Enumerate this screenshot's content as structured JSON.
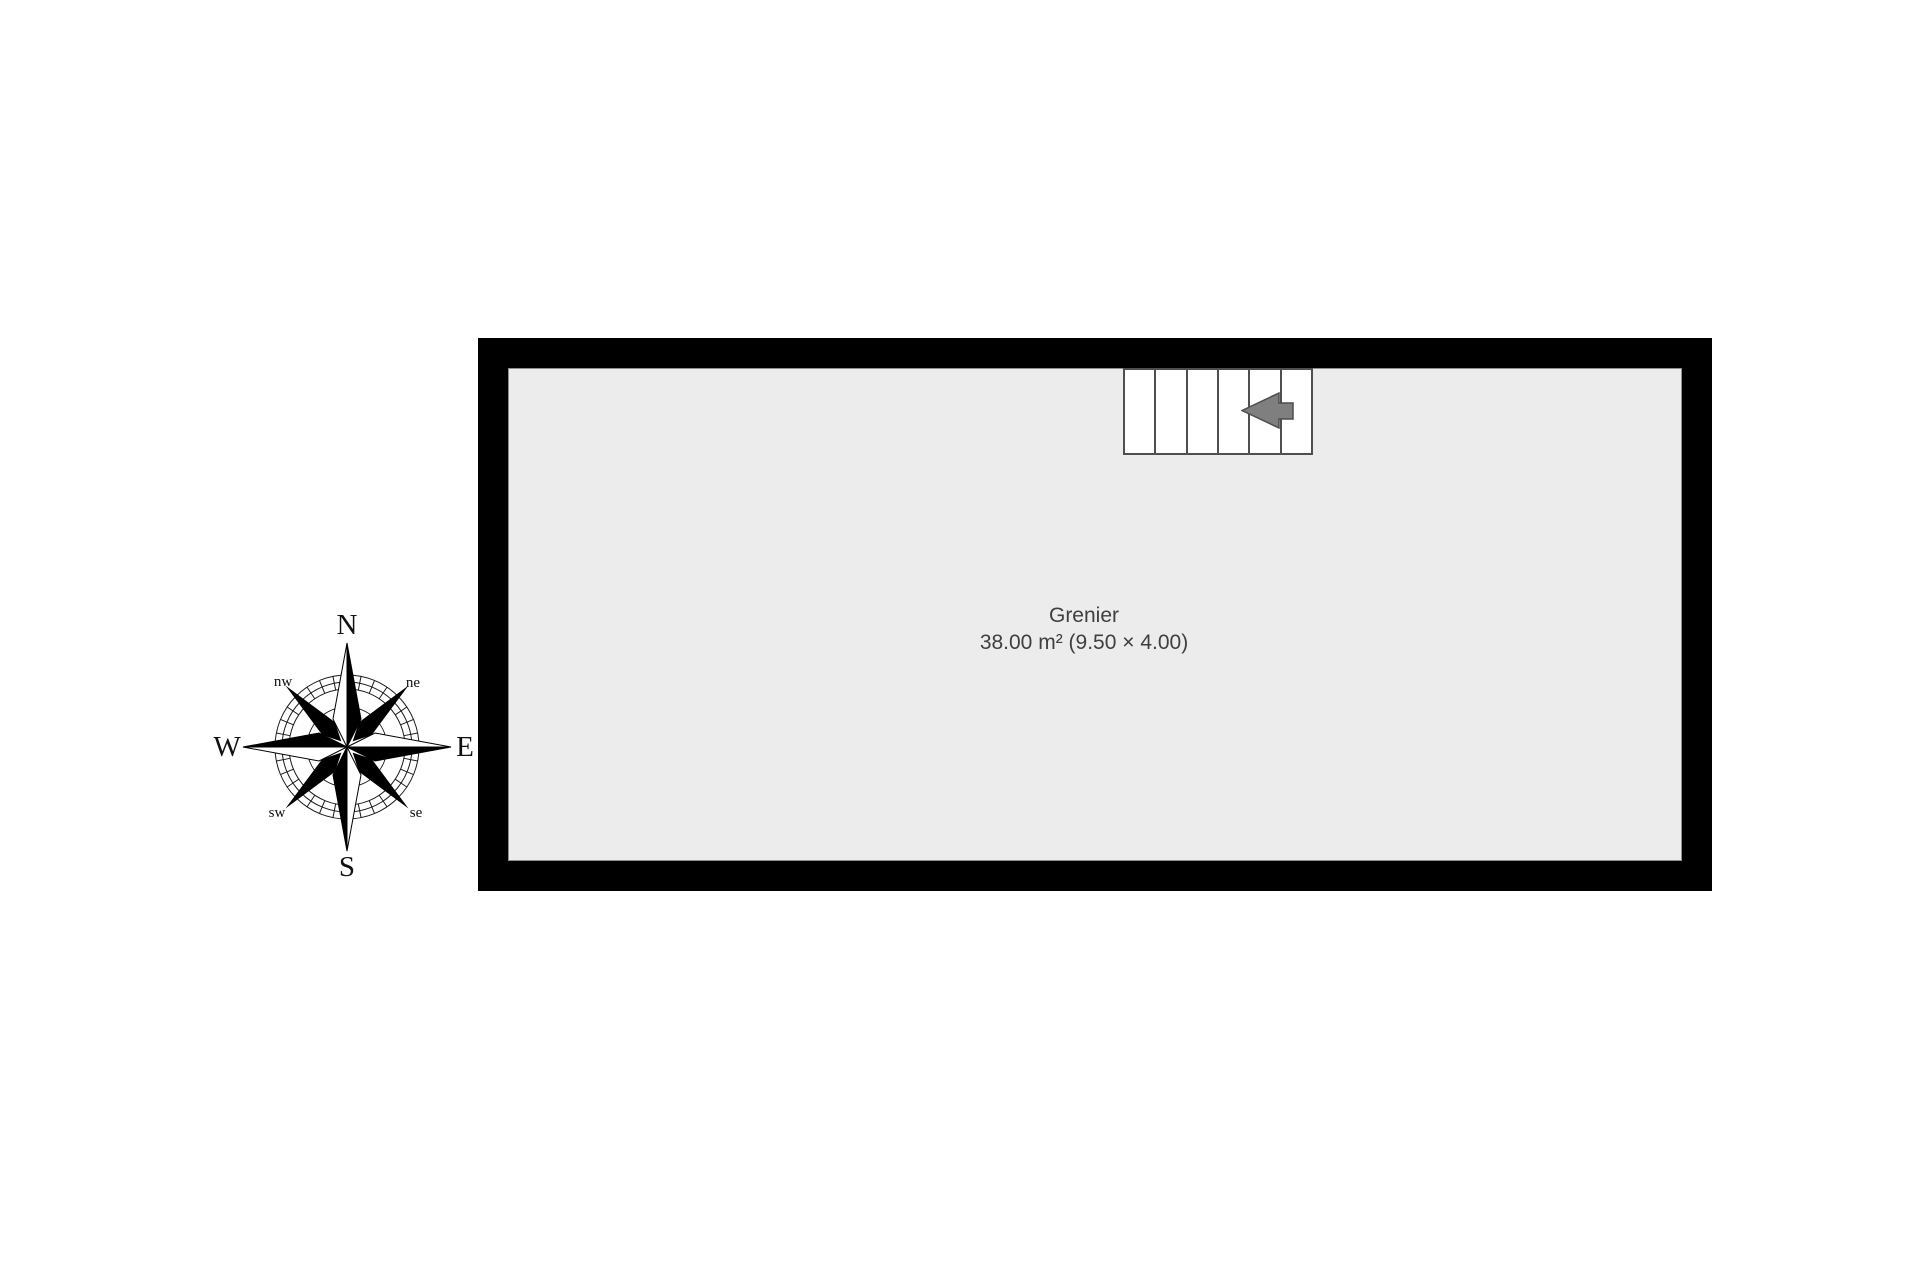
{
  "floor_plan": {
    "room": {
      "name": "Grenier",
      "details": "38.00 m² (9.50 × 4.00)"
    },
    "colors": {
      "wall": "#000000",
      "floor": "#ececec",
      "floor_outline": "#8e8e8e",
      "stair_border": "#4f4f4f",
      "arrow_fill": "#7f7f7f",
      "arrow_stroke": "#4d4d4d",
      "label_text": "#3f3f3f"
    },
    "staircase": {
      "tread_count": 6,
      "arrow_direction": "left"
    }
  },
  "compass": {
    "north": "N",
    "east": "E",
    "south": "S",
    "west": "W",
    "northwest": "nw",
    "northeast": "ne",
    "southwest": "sw",
    "southeast": "se",
    "tick_count": 32
  }
}
